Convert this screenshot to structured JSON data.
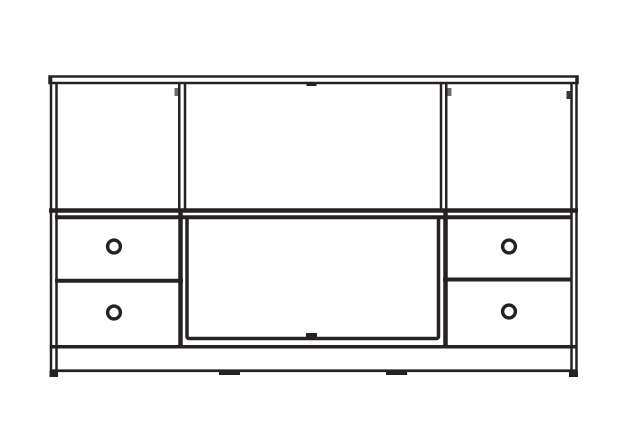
{
  "colors": {
    "background": "#ffffff",
    "line": "#262223",
    "hinge_mark": "#6e6e6e",
    "hinge_mark_dark": "#3a3637"
  },
  "drawing": {
    "type": "line-drawing",
    "subject": "sideboard-cabinet-front-elevation",
    "top_row_compartments": [
      "left-open-compartment",
      "center-open-compartment",
      "right-open-compartment"
    ],
    "bottom_row": {
      "left_drawers": 2,
      "right_drawers": 2,
      "center": "flat-panel-door"
    },
    "knobs": [
      {
        "id": "left-drawer-top-knob",
        "cx": 114,
        "cy": 246.5,
        "r": 6.4
      },
      {
        "id": "left-drawer-bottom-knob",
        "cx": 114,
        "cy": 312.5,
        "r": 6.4
      },
      {
        "id": "right-drawer-top-knob",
        "cx": 509,
        "cy": 246.5,
        "r": 6.4
      },
      {
        "id": "right-drawer-bottom-knob",
        "cx": 509,
        "cy": 311.5,
        "r": 6.4
      }
    ],
    "hinge_marks": [
      {
        "x": 174.5,
        "y": 88,
        "w": 3.5,
        "h": 8,
        "color": "#6e6e6e"
      },
      {
        "x": 447.5,
        "y": 88,
        "w": 4,
        "h": 8,
        "color": "#6e6e6e"
      },
      {
        "x": 566.5,
        "y": 91,
        "w": 4.5,
        "h": 8,
        "color": "#3a3637"
      }
    ],
    "top_tick": {
      "x": 306.5,
      "y": 82.5,
      "w": 10,
      "h": 3.5
    },
    "panel_latch": {
      "x": 306,
      "y": 333,
      "w": 11,
      "h": 4
    },
    "feet": [
      {
        "x": 49.5,
        "y": 371,
        "w": 8.5,
        "h": 6
      },
      {
        "x": 219,
        "y": 370,
        "w": 21,
        "h": 5
      },
      {
        "x": 386,
        "y": 370,
        "w": 21,
        "h": 5
      },
      {
        "x": 569,
        "y": 371,
        "w": 9,
        "h": 6
      }
    ]
  }
}
